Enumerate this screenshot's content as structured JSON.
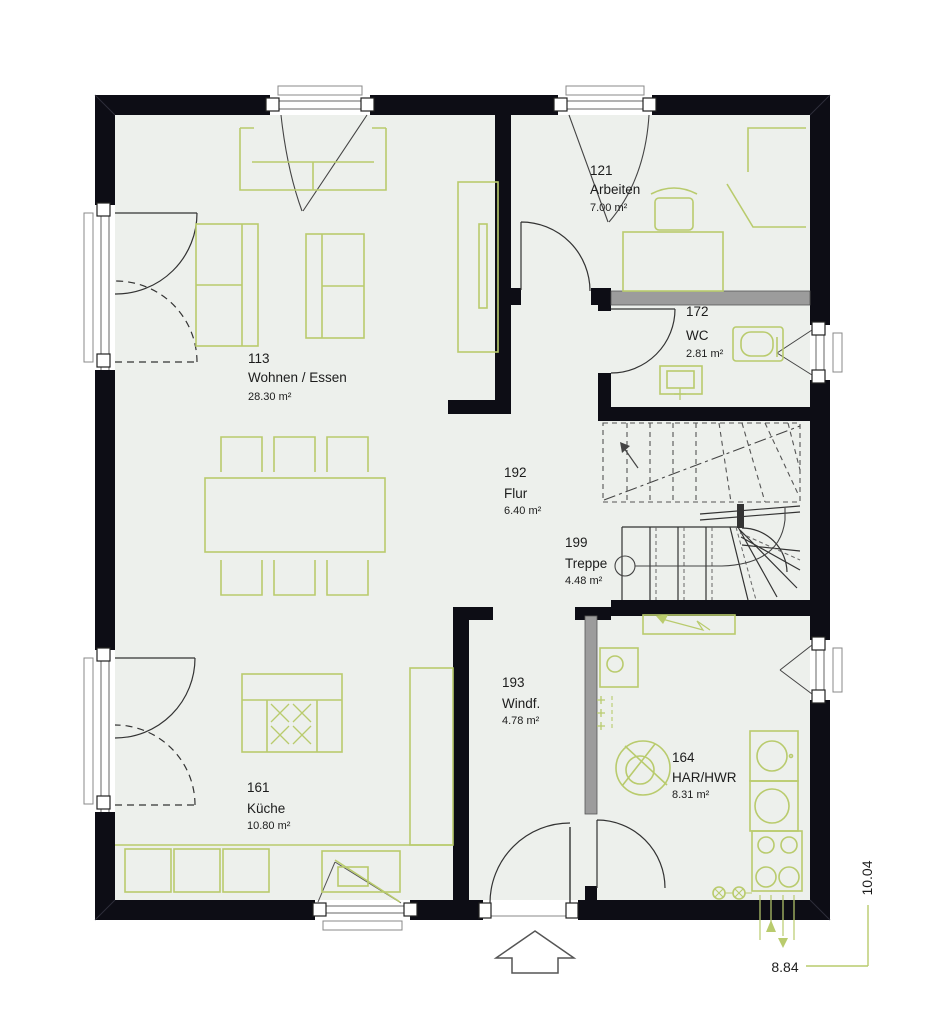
{
  "plan": {
    "title": "Erdgeschoss Grundriss",
    "rooms": {
      "wohnen": {
        "number": "113",
        "name": "Wohnen / Essen",
        "area": "28.30 m²"
      },
      "arbeiten": {
        "number": "121",
        "name": "Arbeiten",
        "area": "7.00 m²"
      },
      "wc": {
        "number": "172",
        "name": "WC",
        "area": "2.81 m²"
      },
      "flur": {
        "number": "192",
        "name": "Flur",
        "area": "6.40 m²"
      },
      "treppe": {
        "number": "199",
        "name": "Treppe",
        "area": "4.48 m²"
      },
      "windfang": {
        "number": "193",
        "name": "Windf.",
        "area": "4.78 m²"
      },
      "kueche": {
        "number": "161",
        "name": "Küche",
        "area": "10.80 m²"
      },
      "har": {
        "number": "164",
        "name": "HAR/HWR",
        "area": "8.31 m²"
      }
    },
    "dimensions": {
      "bottom": "8.84",
      "right": "10.04"
    },
    "colors": {
      "wall": "#0d0d15",
      "floor": "#edf0ec",
      "furniture": "#b9cb6d",
      "installation_wall": "#9c9c9c",
      "dimension_line": "#b9cb6d"
    }
  }
}
